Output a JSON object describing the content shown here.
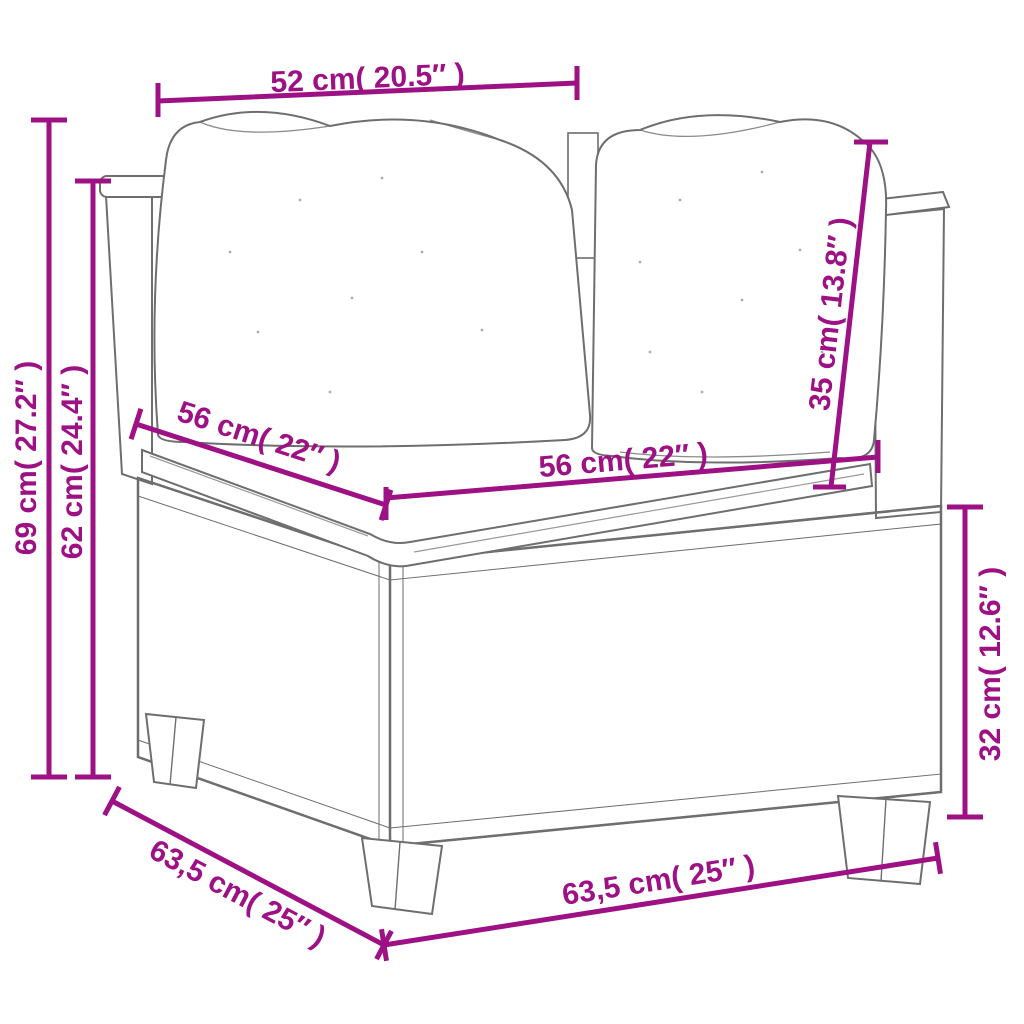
{
  "figure": {
    "type": "product-dimension-diagram"
  },
  "colors": {
    "dimension_accent": "#9D1184",
    "sketch_outline": "#6E6E6E",
    "weave_line": "#909090",
    "background": "#FFFFFF"
  },
  "dims": {
    "top_width": {
      "label": "52 cm( 20.5″ )"
    },
    "total_height": {
      "label": "69 cm( 27.2″ )"
    },
    "back_height": {
      "label": "62 cm( 24.4″ )"
    },
    "seat_depth": {
      "label": "56 cm( 22″ )"
    },
    "seat_width": {
      "label": "56 cm( 22″ )"
    },
    "back_cushion_height": {
      "label": "35 cm( 13.8″ )"
    },
    "base_height": {
      "label": "32 cm( 12.6″ )"
    },
    "base_depth": {
      "label": "63,5 cm( 25″ )"
    },
    "base_width": {
      "label": "63,5 cm( 25″ )"
    }
  }
}
